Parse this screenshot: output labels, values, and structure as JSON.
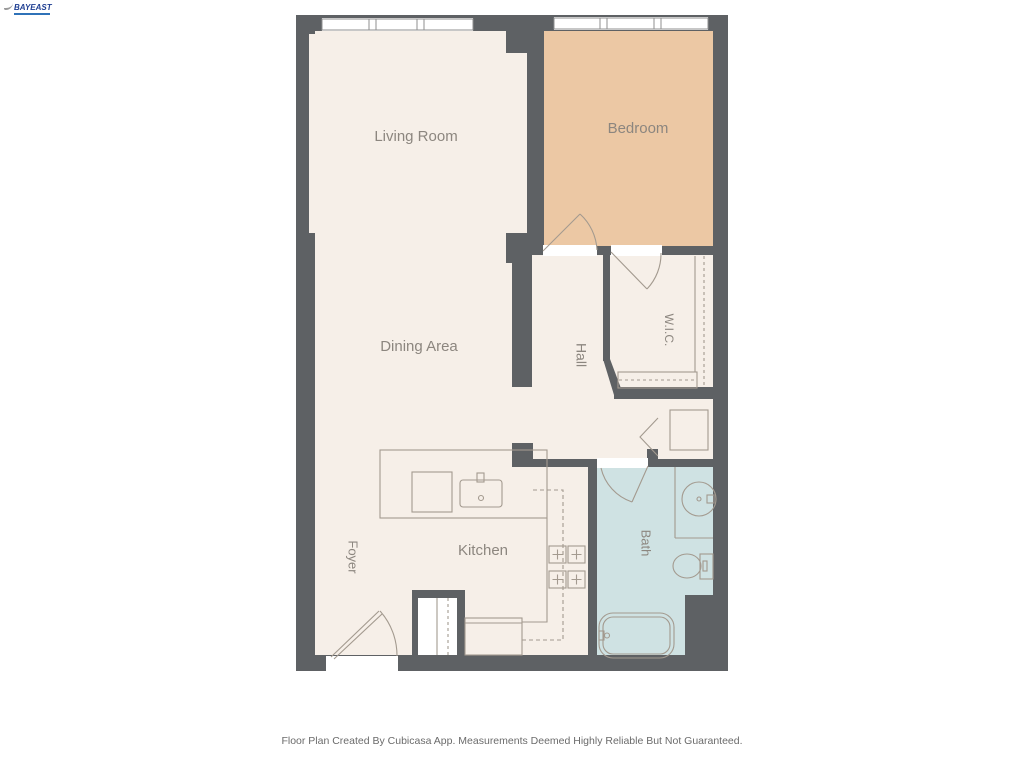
{
  "logo": {
    "text": "BAYEAST"
  },
  "floor_plan": {
    "rooms": [
      {
        "id": "living-room",
        "label": "Living Room"
      },
      {
        "id": "bedroom",
        "label": "Bedroom"
      },
      {
        "id": "dining-area",
        "label": "Dining Area"
      },
      {
        "id": "hall",
        "label": "Hall"
      },
      {
        "id": "wic",
        "label": "W.I.C."
      },
      {
        "id": "kitchen",
        "label": "Kitchen"
      },
      {
        "id": "foyer",
        "label": "Foyer"
      },
      {
        "id": "bath",
        "label": "Bath"
      }
    ],
    "colors": {
      "wall": "#5E6164",
      "floor": "#F6EFE8",
      "bedroom_floor": "#ECC8A4",
      "bath_floor": "#CFE2E3",
      "fixture_line": "#A39A8F",
      "window_frame": "#8F8F8F",
      "label_text": "#8C867F",
      "threshold": "#FFFFFF"
    },
    "footer": "Floor Plan Created By Cubicasa App. Measurements Deemed Highly Reliable But Not Guaranteed."
  }
}
